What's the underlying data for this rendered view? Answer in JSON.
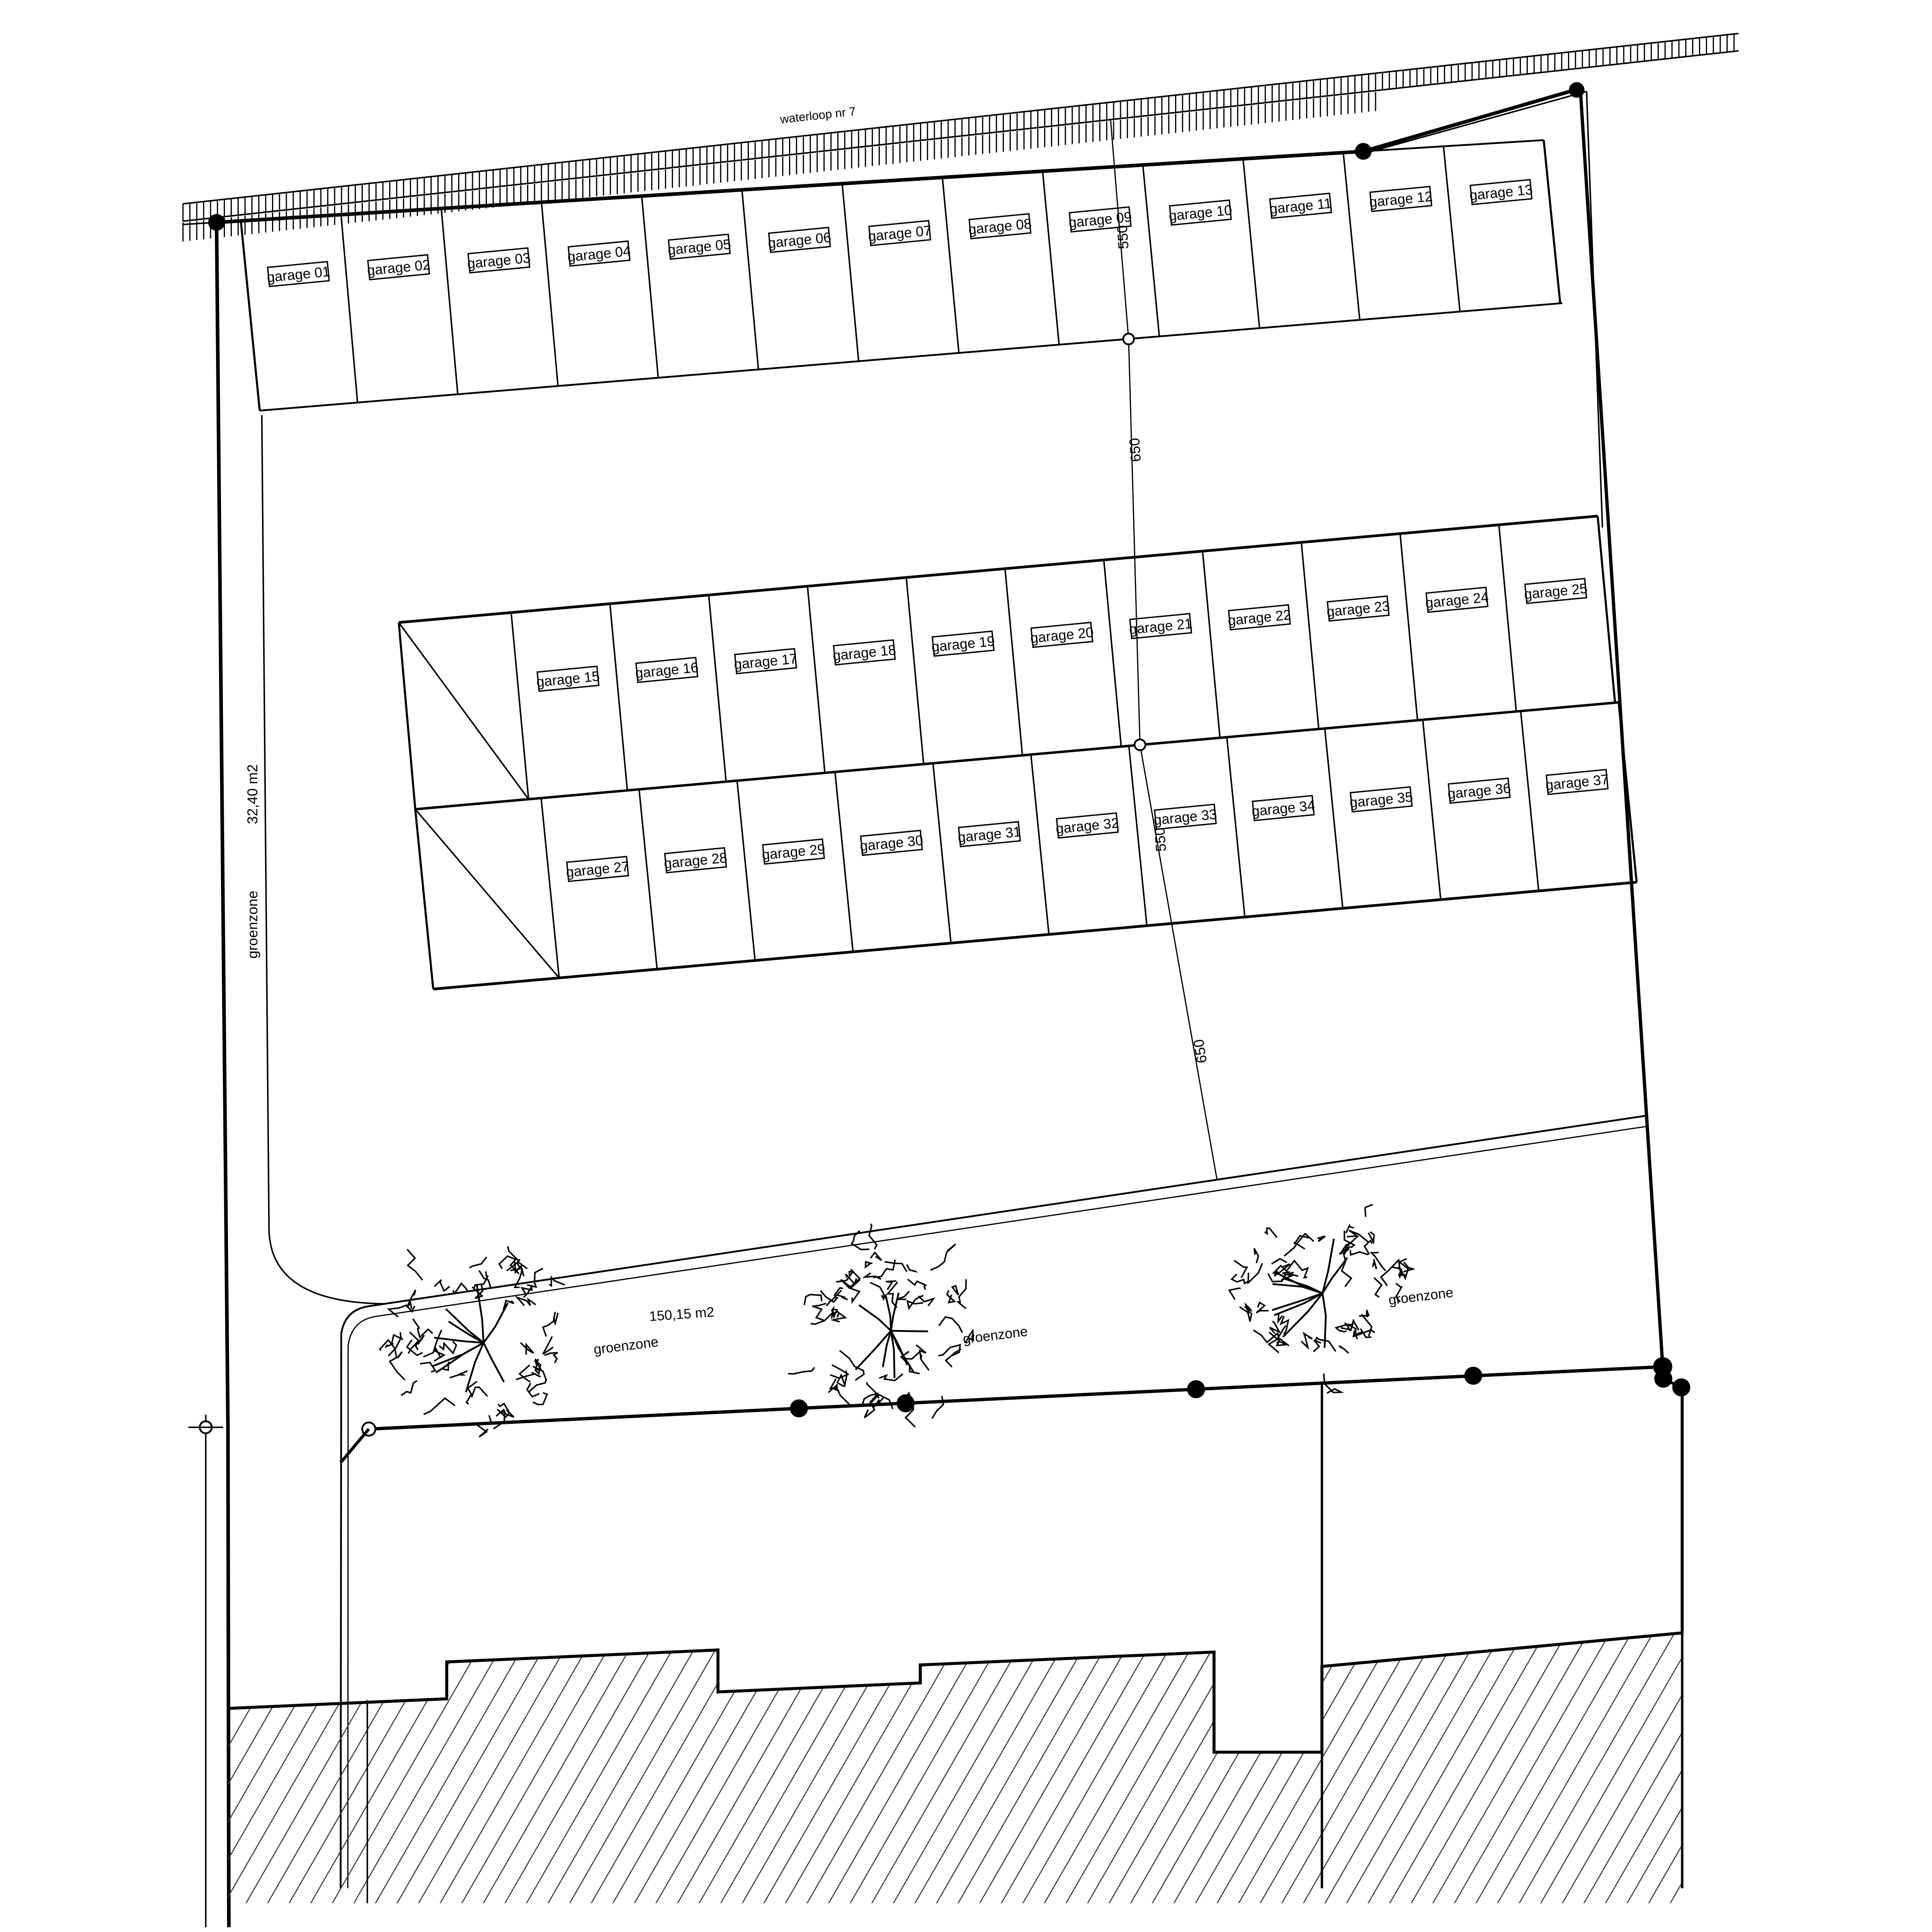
{
  "waterway": {
    "label": "waterloop nr 7"
  },
  "green_strip": {
    "label": "groenzone",
    "area": "32,40 m2"
  },
  "green_zone": {
    "area": "150,15 m2",
    "label_left": "groenzone",
    "label_mid": "groenzone",
    "label_right": "groenzone"
  },
  "dims": {
    "top": "550",
    "upper_gap": "650",
    "mid": "550",
    "lower_gap": "650"
  },
  "garage_rows": [
    {
      "id": "row-top",
      "labels": [
        "garage 01",
        "garage 02",
        "garage 03",
        "garage 04",
        "garage 05",
        "garage 06",
        "garage 07",
        "garage 08",
        "garage 09",
        "garage 10",
        "garage 11",
        "garage 12",
        "garage 13"
      ]
    },
    {
      "id": "row-middle-upper",
      "labels": [
        "garage 15",
        "garage 16",
        "garage 17",
        "garage 18",
        "garage 19",
        "garage 20",
        "garage 21",
        "garage 22",
        "garage 23",
        "garage 24",
        "garage 25"
      ]
    },
    {
      "id": "row-middle-lower",
      "labels": [
        "garage 27",
        "garage 28",
        "garage 29",
        "garage 30",
        "garage 31",
        "garage 32",
        "garage 33",
        "garage 34",
        "garage 35",
        "garage 36",
        "garage 37"
      ]
    }
  ],
  "colors": {
    "line": "#000000",
    "hatch": "#3a3a3a",
    "background": "#ffffff"
  }
}
